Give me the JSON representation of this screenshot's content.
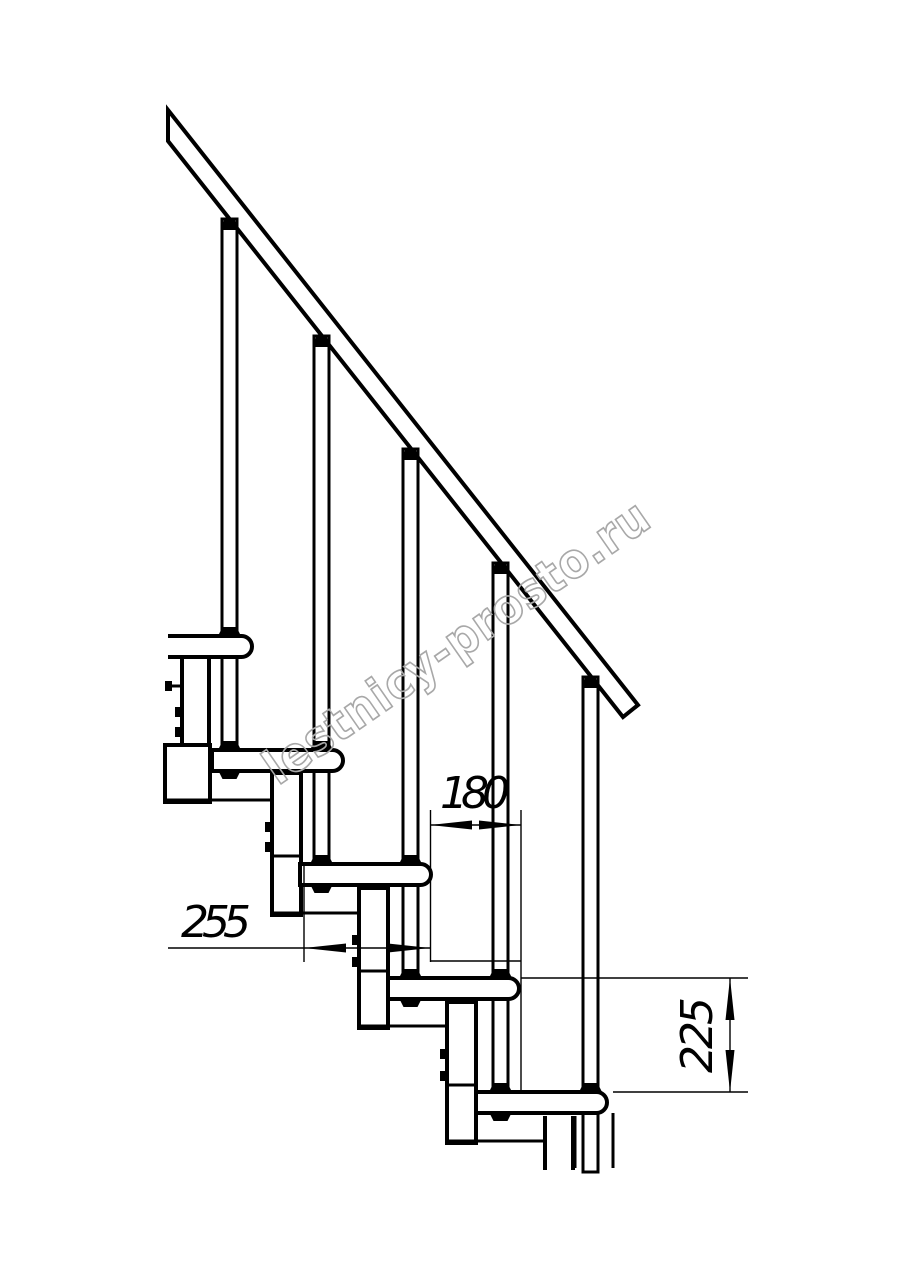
{
  "title": "Modular staircase side-view technical drawing",
  "watermark": {
    "text": "lestnicy-prosto.ru",
    "color": "#a8a8a8"
  },
  "dimensions": {
    "run": "180",
    "depth": "255",
    "rise": "225"
  },
  "drawing": {
    "steps_visible": 5,
    "balusters_visible": 5,
    "line_color": "#000000",
    "background_color": "#ffffff"
  }
}
